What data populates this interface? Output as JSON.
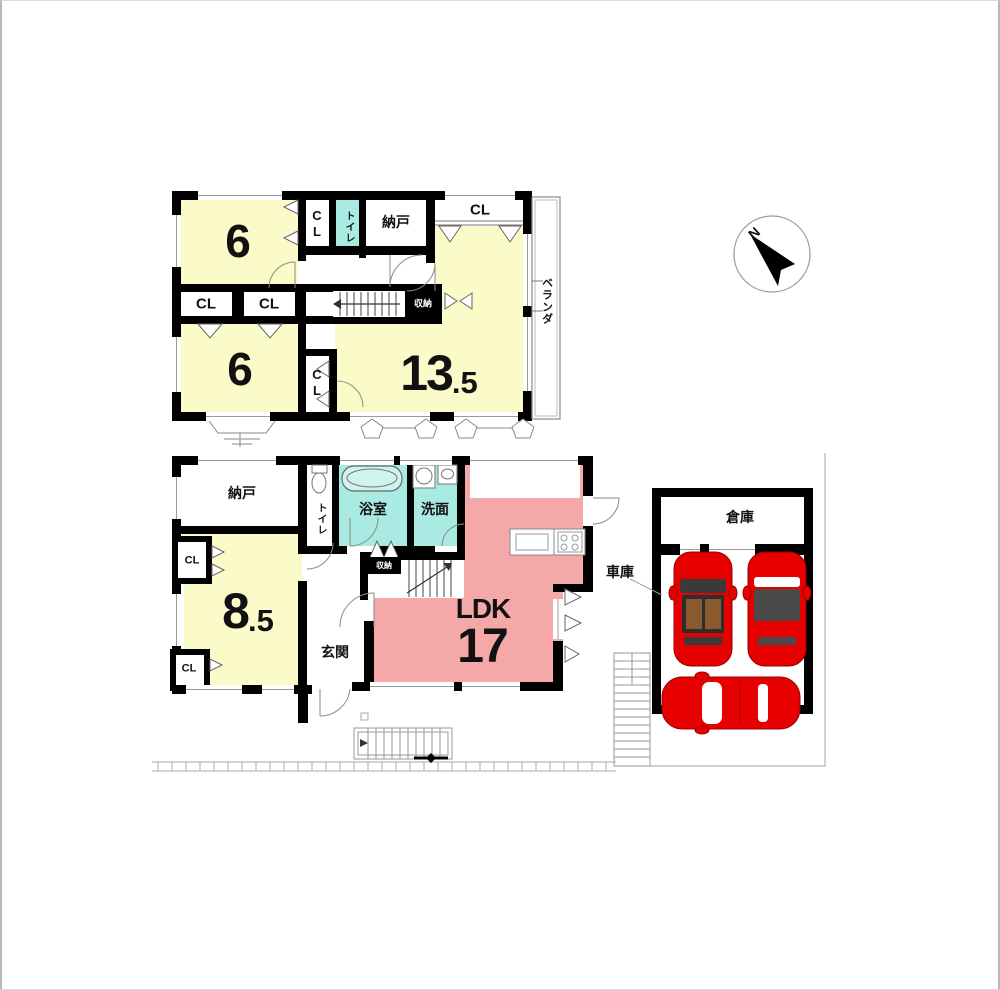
{
  "compass": {
    "north": "N"
  },
  "floor2": {
    "room6_top": "6",
    "cl_vertical_top": "CL",
    "toilet": "トイレ",
    "nando": "納戸",
    "cl_top_right": "CL",
    "cl_mid_left_1": "CL",
    "cl_mid_left_2": "CL",
    "shuno": "収納",
    "room6_bottom": "6",
    "cl_vertical_bottom": "CL",
    "room135": {
      "main": "13",
      "dec": ".5"
    },
    "veranda": "ベランダ"
  },
  "floor1": {
    "nando": "納戸",
    "toilet": "トイレ",
    "bath": "浴室",
    "wash": "洗面",
    "cl_top": "CL",
    "room85": {
      "main": "8",
      "dec": ".5"
    },
    "cl_bottom": "CL",
    "genkan": "玄関",
    "shuno": "収納",
    "ldk": "LDK",
    "ldk_size": "17"
  },
  "garage": {
    "warehouse": "倉庫",
    "garage_label": "車庫"
  },
  "colors": {
    "room_yellow": "#FBFBC9",
    "room_pink": "#F5A8A8",
    "room_cyan": "#A9EAE3",
    "car_red": "#E60000",
    "wall": "#000000"
  }
}
